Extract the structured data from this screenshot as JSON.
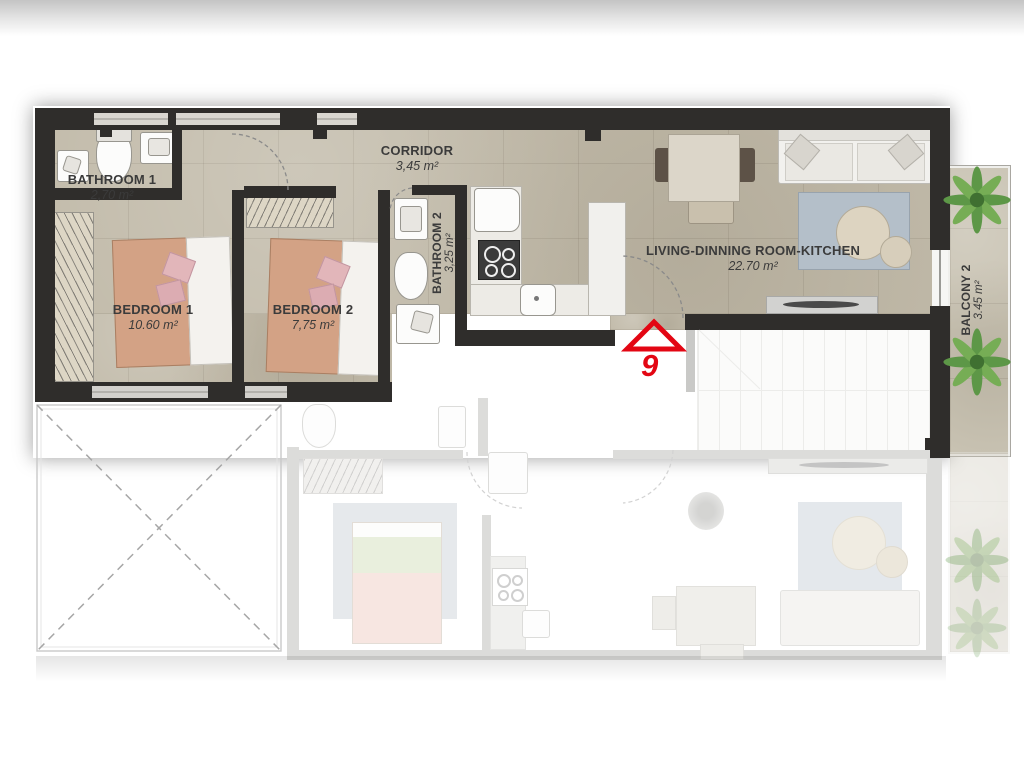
{
  "unit": {
    "number": "9"
  },
  "rooms": {
    "bathroom1": {
      "name": "BATHROOM 1",
      "area": "2,70 m²"
    },
    "corridor": {
      "name": "CORRIDOR",
      "area": "3,45 m²"
    },
    "bathroom2": {
      "name": "BATHROOM 2",
      "area": "3,25 m²"
    },
    "bedroom1": {
      "name": "BEDROOM 1",
      "area": "10.60 m²"
    },
    "bedroom2": {
      "name": "BEDROOM 2",
      "area": "7,75 m²"
    },
    "living": {
      "name": "LIVING-DINNING ROOM-KITCHEN",
      "area": "22.70 m²"
    },
    "balcony2": {
      "name": "BALCONY 2",
      "area": "3.45 m²"
    }
  },
  "colors": {
    "wall": "#2f2d2b",
    "floor": "#c2bbaa",
    "accent_red": "#e30613",
    "ghost_wall": "#dcdcda",
    "rug_blue": "#b4bfc9",
    "label_text": "#3b3b3b",
    "plant_green": "#5d9747"
  },
  "icons": {
    "entrance_marker": "entrance-triangle-icon",
    "plants": "plant-icon",
    "beds": "bed-icon",
    "toilets": "toilet-icon",
    "sinks": "sink-icon",
    "shower": "shower-icon",
    "stove": "stove-icon",
    "fridge": "fridge-icon",
    "sofa": "sofa-icon",
    "dining_table": "dining-table-icon",
    "coffee_tables": "coffee-table-icon",
    "stairs": "staircase",
    "void_area": "void-x-marker"
  }
}
